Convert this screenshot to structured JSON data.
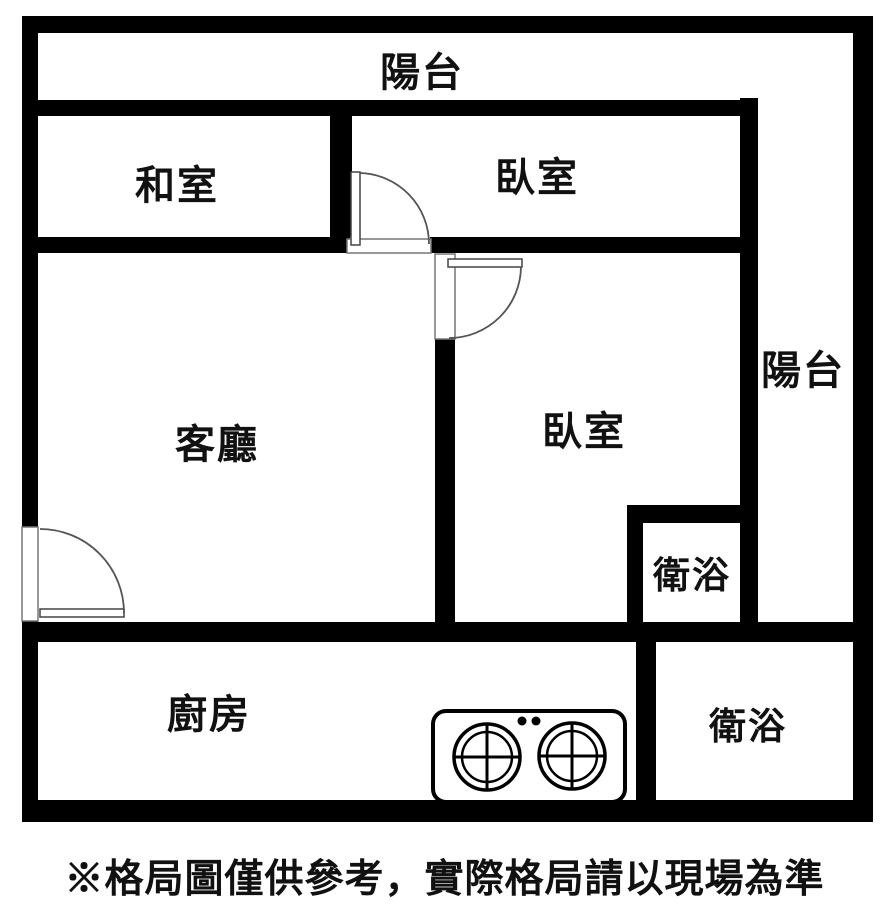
{
  "plan": {
    "type": "apartment-floor-plan",
    "rooms": [
      {
        "id": "balcony-top",
        "label": "陽台"
      },
      {
        "id": "tatami-room",
        "label": "和室"
      },
      {
        "id": "bedroom-top",
        "label": "臥室"
      },
      {
        "id": "balcony-right",
        "label": "陽台"
      },
      {
        "id": "living-room",
        "label": "客廳"
      },
      {
        "id": "bedroom-right",
        "label": "臥室"
      },
      {
        "id": "bathroom-inner",
        "label": "衛浴"
      },
      {
        "id": "kitchen",
        "label": "廚房"
      },
      {
        "id": "bathroom-bottom",
        "label": "衛浴"
      }
    ],
    "fixtures": [
      {
        "id": "stove",
        "burners": 2,
        "location": "kitchen"
      }
    ],
    "doors": [
      {
        "id": "door-bedroom-top",
        "between": [
          "bedroom-top",
          "bedroom-right"
        ]
      },
      {
        "id": "door-bedroom-right",
        "between": [
          "living-room",
          "bedroom-right"
        ]
      },
      {
        "id": "door-living-room",
        "between": [
          "outside",
          "living-room"
        ]
      }
    ],
    "colors": {
      "wall": "#000000",
      "background": "#ffffff",
      "door_line": "#555555",
      "text": "#111111"
    }
  },
  "disclaimer": "※格局圖僅供參考，實際格局請以現場為準"
}
